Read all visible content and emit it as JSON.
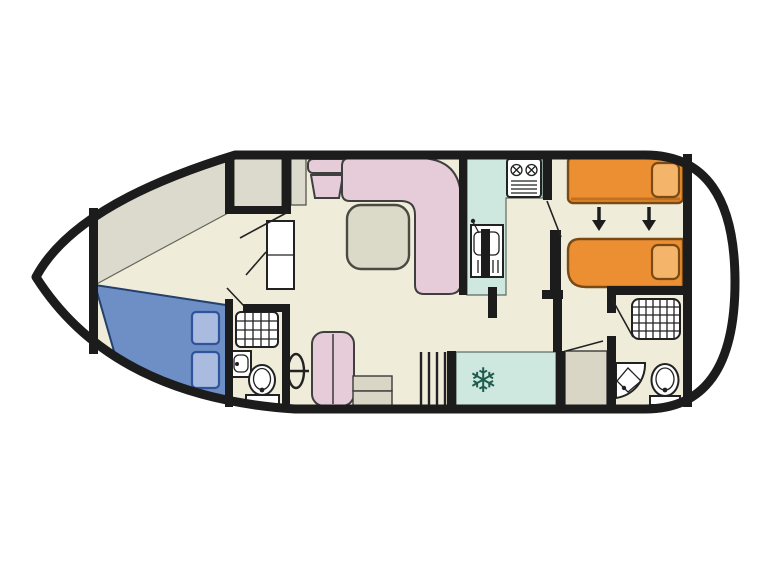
{
  "app": {
    "type": "boat-deck-plan",
    "description": "Top-down floor plan of a motor cruiser, bow pointing left"
  },
  "visible_text": "none",
  "icons": {
    "snowflake_glyph": "❄",
    "names": [
      "fridge-snowflake-icon",
      "stove-burners-icon",
      "galley-sink-icon",
      "shower-grid-icon",
      "washbasin-icon",
      "toilet-icon",
      "corner-basin-icon",
      "helm-wheel-icon",
      "bed-convert-arrow-icon",
      "stairs-icon",
      "steps-icon"
    ]
  },
  "regions": {
    "bow_deck": "open bow point (white)",
    "forward_cabin": "double bed cabin (blue bed, two pillows)",
    "forward_bathroom": "shower, washbasin, toilet",
    "saloon": "L-shaped sofa, armchair, table, helm seat and wheel, steps",
    "galley": "mint counter with stove and sink, fridge with snowflake",
    "aft_cabin": "two orange single beds with convert arrows",
    "aft_bathroom": "shower, corner basin, toilet",
    "aft_deck": "open stern deck (white)"
  },
  "colors": {
    "exterior_white": "#ffffff",
    "floor": "#efecd9",
    "deck_olive": "#dcdacc",
    "wall_black": "#1c1c1c",
    "bed_double": "#6d8fc5",
    "pillow_blue": "#a9bbdf",
    "seating_pink": "#e6cbd9",
    "table_grey": "#dbd9c7",
    "galley_mint": "#cfe8df",
    "bed_single_orange": "#ec8f33",
    "pillow_orange": "#f4b469",
    "fixture_white": "#ffffff",
    "steps_grey": "#d9d6c6",
    "snowflake_teal": "#1e5c4e"
  }
}
